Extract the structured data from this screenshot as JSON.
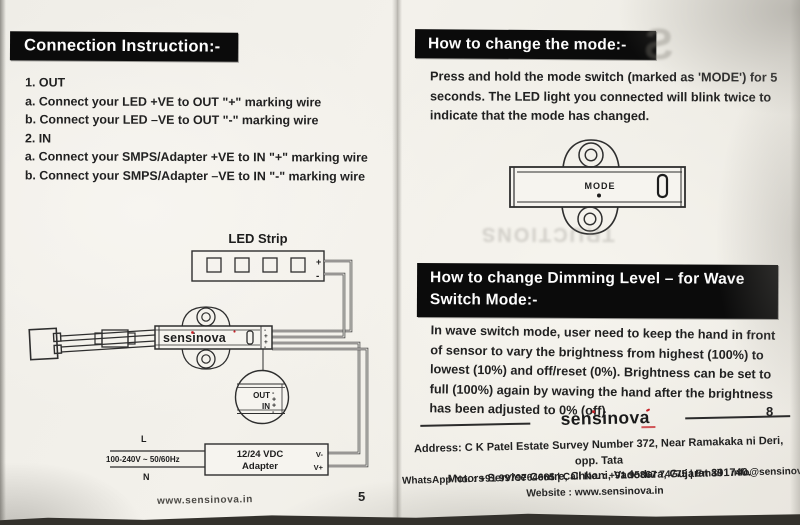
{
  "page_left": {
    "title": "Connection Instruction:-",
    "steps": [
      "1. OUT",
      "a. Connect your LED +VE to OUT \"+\" marking wire",
      "b. Connect your LED –VE to OUT \"-\" marking wire",
      "2. IN",
      "a. Connect your SMPS/Adapter +VE to IN \"+\" marking wire",
      "b. Connect your SMPS/Adapter –VE to IN \"-\" marking wire"
    ],
    "diagram": {
      "led_strip_label": "LED Strip",
      "strip_plus": "+",
      "strip_minus": "-",
      "device_brand": "sensinova",
      "terminal_marks": [
        "-",
        "+",
        "+",
        "-"
      ],
      "magnifier": {
        "out_label": "OUT",
        "in_label": "IN",
        "out_minus": "-",
        "out_plus": "+",
        "in_plus": "+",
        "in_minus": "-"
      },
      "line_live": "L",
      "line_neutral": "N",
      "mains_rating": "100-240V ~ 50/60Hz",
      "adapter_line1": "12/24 VDC",
      "adapter_line2": "Adapter",
      "v_minus": "V-",
      "v_plus": "V+"
    },
    "footer_website": "www.sensinova.in",
    "page_number": "5"
  },
  "page_right": {
    "section_mode": {
      "title": "How to change the mode:-",
      "body": "Press and hold the mode switch (marked as 'MODE') for 5 seconds. The LED light you connected will blink twice to indicate that the mode has changed.",
      "mode_label": "MODE"
    },
    "section_dimming": {
      "title_line1": "How to change Dimming Level – for Wave",
      "title_line2": "Switch Mode:-",
      "body": "In wave switch mode, user need to keep the hand in front of sensor to vary the brightness from highest (100%) to lowest (10%) and off/reset (0%). Brightness can be set to full (100%) again by waving the hand after the brightness has been adjusted to 0% (off)"
    },
    "page_number": "8",
    "footer": {
      "brand": "sensinova",
      "address_line1": "Address: C K Patel Estate Survey Number 372, Near Ramakaka ni Deri, opp. Tata",
      "address_line2": "Motors Service Centre, Chhani, Vadodara, Gujarat 391740.",
      "contact_line": "WhatsApp No. : +91 9979764665   |   Call No. : +91 95867 74775   |   Email : info@sensinova.in",
      "website_line": "Website : www.sensinova.in"
    }
  },
  "artifacts": {
    "bleed_letter": "S",
    "bleed_text": "TRUCTIONS"
  },
  "colors": {
    "paper": "#f3f1eb",
    "ink": "#1f1f1f",
    "header_bg": "#0b0b0b",
    "header_text": "#ffffff",
    "brand_red": "#c52127",
    "photo_band": "#33312c"
  }
}
